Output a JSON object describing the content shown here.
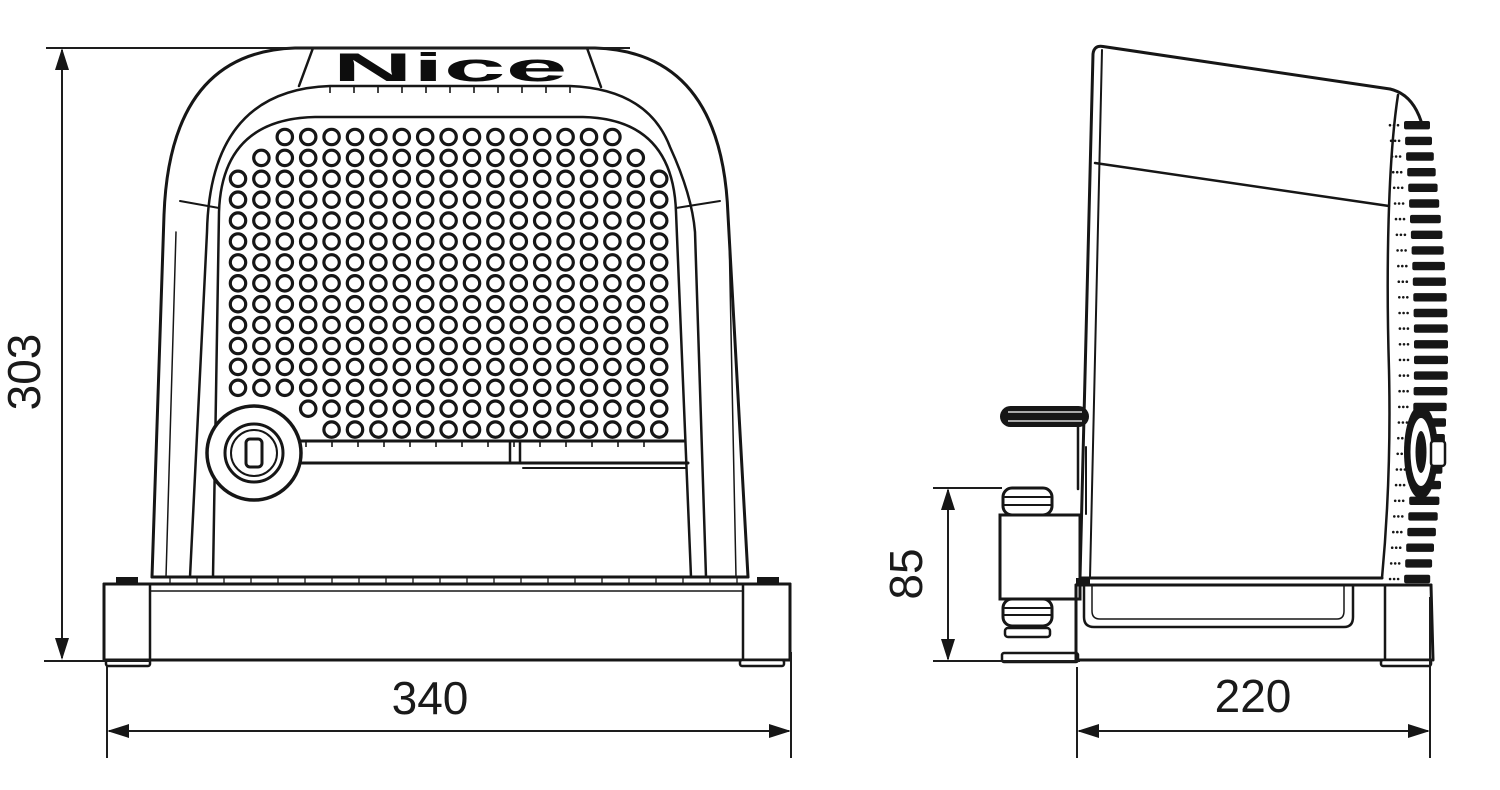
{
  "drawing": {
    "brand_logo": "Nice",
    "dimensions": {
      "height_mm": "303",
      "base_width_mm": "340",
      "depth_mm": "220",
      "pinion_height_mm": "85"
    }
  }
}
